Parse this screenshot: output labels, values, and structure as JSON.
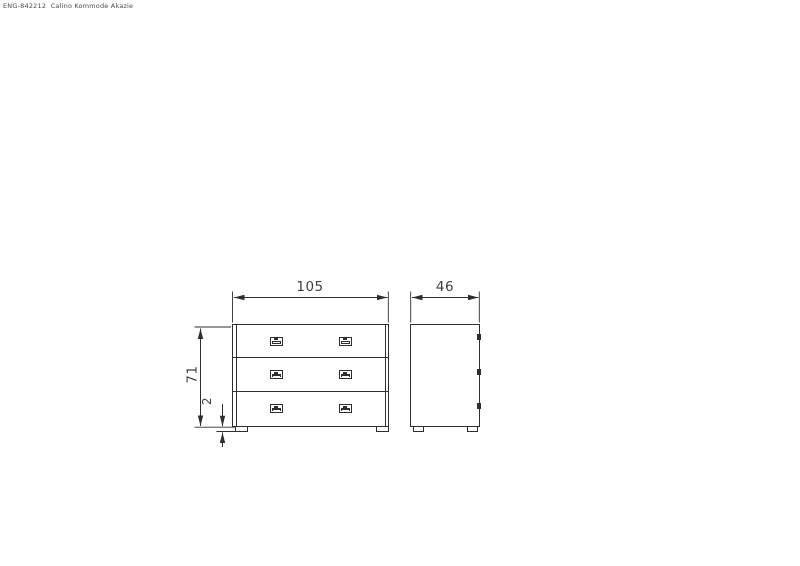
{
  "document_label": "ENG-842212  Calino Kommode Akazie",
  "dimensions": {
    "width_cm": "105",
    "depth_cm": "46",
    "height_cm": "71",
    "foot_height_cm": "2"
  },
  "views": {
    "front": {
      "drawers": 3,
      "handles_per_drawer": 2,
      "feet": 2
    },
    "side": {
      "feet": 2,
      "handle_profiles": 3
    }
  },
  "colors": {
    "background": "#ffffff",
    "line": "#2e2e2e",
    "dim-text": "#3d3d3d",
    "label-text": "#4a4a4a"
  }
}
